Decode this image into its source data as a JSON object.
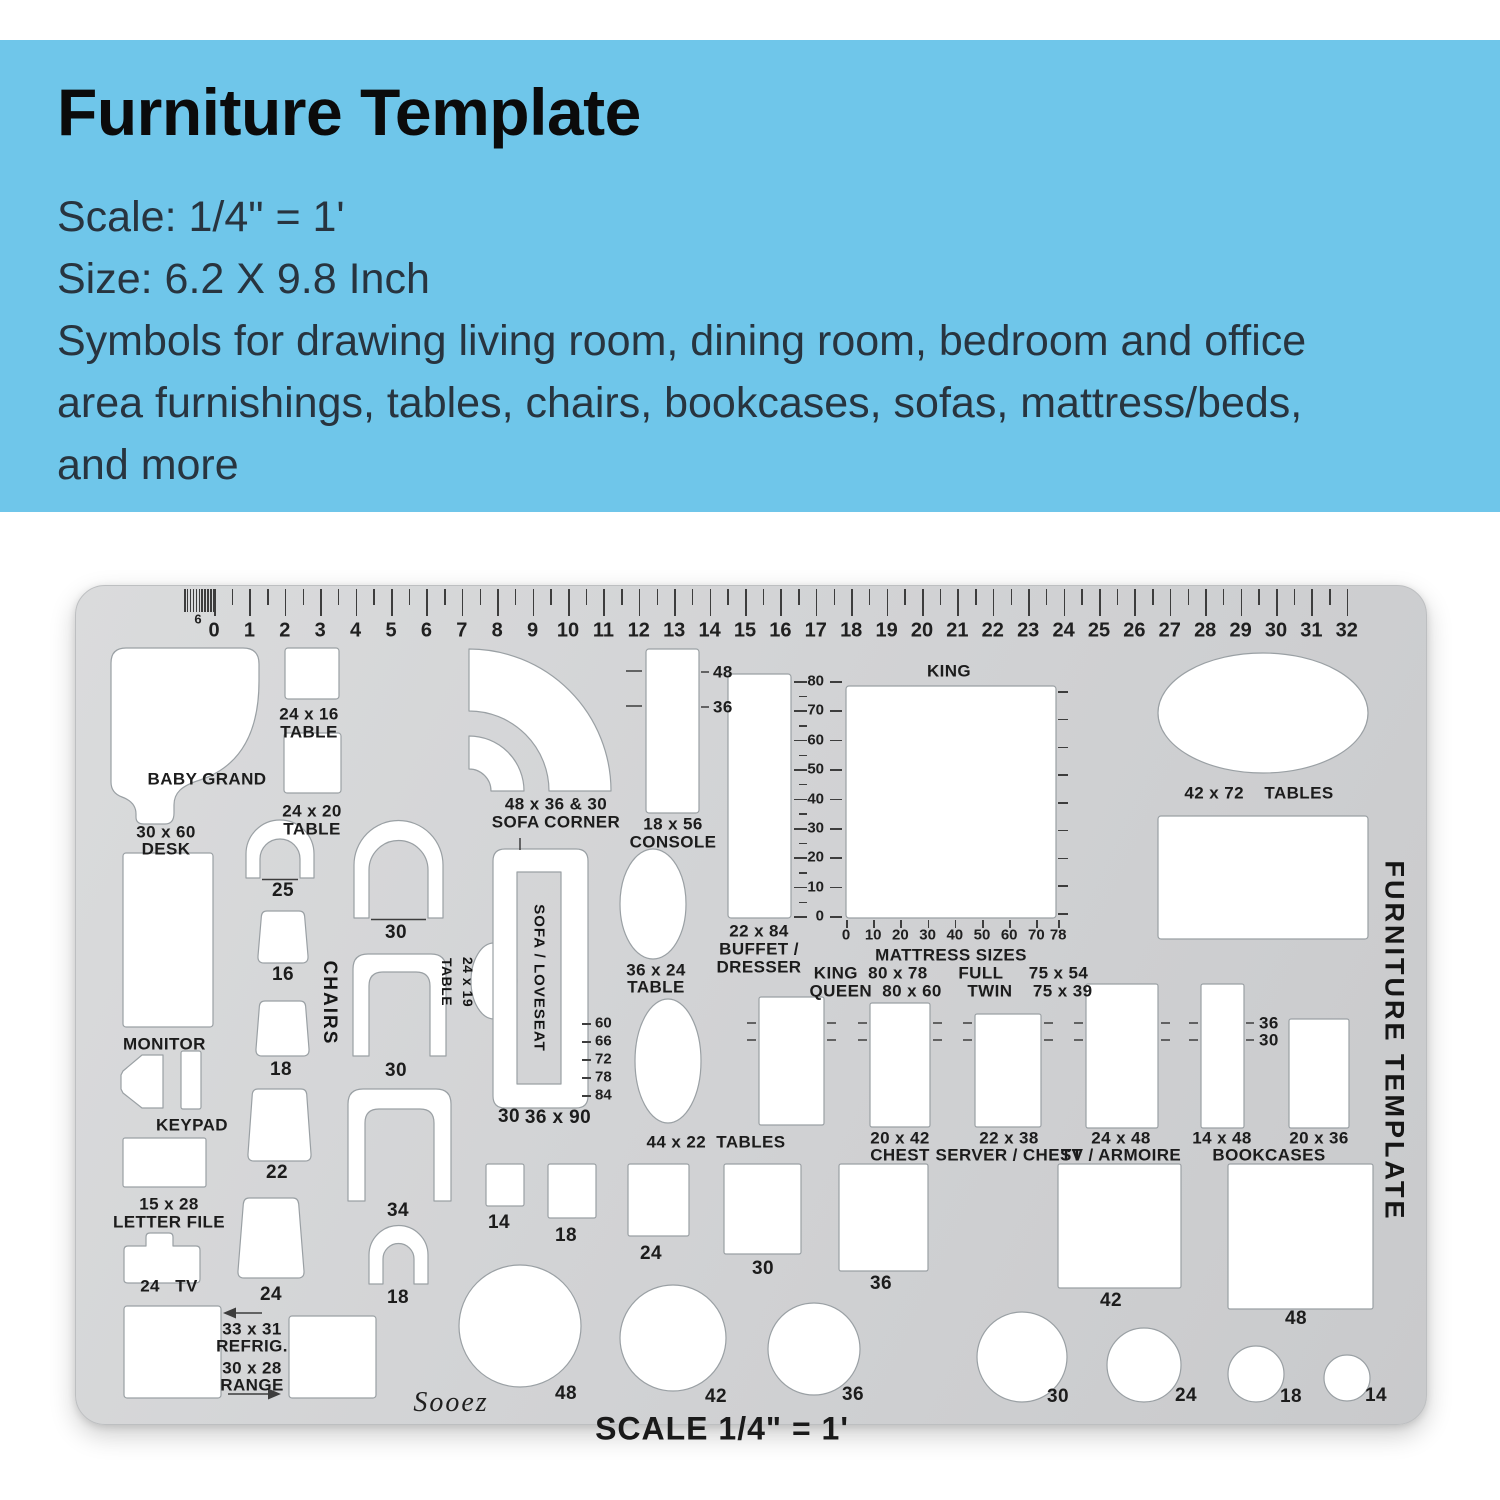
{
  "header": {
    "title": "Furniture Template",
    "lines": [
      "Scale: 1/4\" = 1'",
      "Size: 6.2 X 9.8 Inch",
      "Symbols for drawing living room, dining room, bedroom and office",
      "area furnishings, tables, chairs, bookcases, sofas, mattress/beds,",
      "and more"
    ],
    "accent_color": "#6fc6ea"
  },
  "template": {
    "side_title": "FURNITURE TEMPLATE",
    "brand": "Sooez",
    "scale_note": "SCALE 1/4\" = 1'",
    "ruler": {
      "fine_label": "6",
      "numbers": [
        0,
        1,
        2,
        3,
        4,
        5,
        6,
        7,
        8,
        9,
        10,
        11,
        12,
        13,
        14,
        15,
        16,
        17,
        18,
        19,
        20,
        21,
        22,
        23,
        24,
        25,
        26,
        27,
        28,
        29,
        30,
        31,
        32
      ]
    },
    "scales": {
      "buffet_vertical": [
        "80",
        "70",
        "60",
        "50",
        "40",
        "30",
        "20",
        "10",
        "0"
      ],
      "mattress_bottom": [
        "0",
        "10",
        "20",
        "30",
        "40",
        "50",
        "60",
        "70",
        "78"
      ],
      "mattress_bottom_values": [
        0,
        10,
        20,
        30,
        40,
        50,
        60,
        70,
        78
      ],
      "sofa_lengths": [
        "60",
        "66",
        "72",
        "78",
        "84"
      ]
    },
    "labels": {
      "baby_grand": "BABY GRAND",
      "desk_size": "30 x 60",
      "desk_name": "DESK",
      "t2416_size": "24 x 16",
      "t2416_name": "TABLE",
      "t2420_size": "24 x 20",
      "t2420_name": "TABLE",
      "sofa_corner_size": "48 x 36 & 30",
      "sofa_corner_name": "SOFA CORNER",
      "console_size": "18 x 56",
      "console_name": "CONSOLE",
      "tick48": "48",
      "tick36": "36",
      "buffet_size": "22 x 84",
      "buffet_name1": "BUFFET /",
      "buffet_name2": "DRESSER",
      "king": "KING",
      "mattress_title": "MATTRESS SIZES",
      "mattress_row1": "KING  80 x 78      FULL     75 x 54",
      "mattress_row2": "QUEEN  80 x 60     TWIN    75 x 39",
      "t4272": "42 x 72    TABLES",
      "chair25": "25",
      "chair16": "16",
      "chair18": "18",
      "chair22": "22",
      "chair24": "24",
      "chair30a": "30",
      "chair30b": "30",
      "chair34": "34",
      "chair18s": "18",
      "chairs_title": "CHAIRS",
      "t2419_size": "24 x 19",
      "t2419_name": "TABLE",
      "sofa_loveseat": "SOFA / LOVESEAT",
      "sofa_w": "30",
      "sofa_l": "36 x 90",
      "t3624_size": "36 x 24",
      "t3624_name": "TABLE",
      "t4422": "44 x 22  TABLES",
      "chest_size": "20 x 42",
      "chest_name": "CHEST",
      "server_size": "22 x 38",
      "server_name": "SERVER / CHEST",
      "armoire_size": "24 x 48",
      "armoire_name": "TV / ARMOIRE",
      "b1448": "14 x 48",
      "b2036": "20 x 36",
      "bookcases": "BOOKCASES",
      "btick36": "36",
      "btick30": "30",
      "sq14": "14",
      "sq18": "18",
      "sq24": "24",
      "sq30": "30",
      "sq36": "36",
      "sq42": "42",
      "sq48": "48",
      "ci48": "48",
      "ci42": "42",
      "ci36": "36",
      "ci30": "30",
      "ci24": "24",
      "ci18": "18",
      "ci14": "14",
      "monitor": "MONITOR",
      "keypad": "KEYPAD",
      "lf_size": "15 x 28",
      "lf_name": "LETTER FILE",
      "tv": "24   TV",
      "refrig_size": "33 x 31",
      "refrig_name": "REFRIG.",
      "range_size": "30 x 28",
      "range_name": "RANGE"
    }
  }
}
